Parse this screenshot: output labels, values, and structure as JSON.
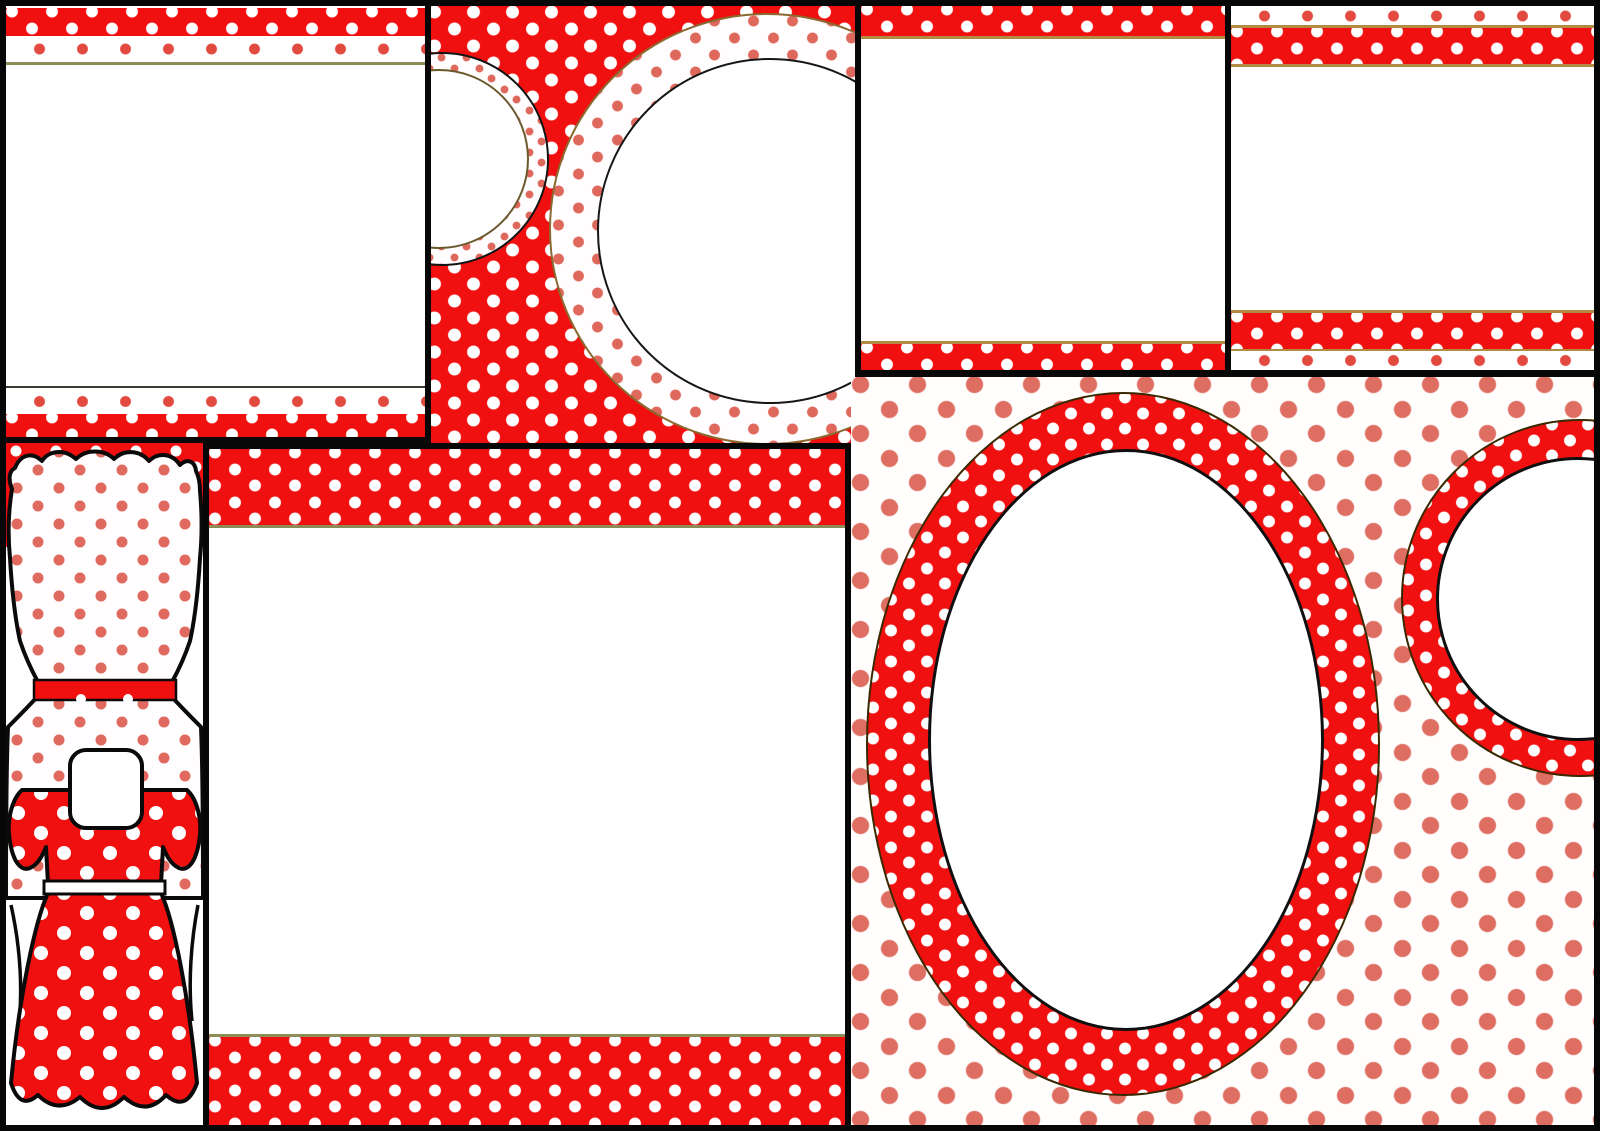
{
  "page": {
    "description": "Collage of seven blank red-and-white polka dot printable party templates: framed cards, ribbon-band labels, circular toppers and a polka dot dress cutout. No text content.",
    "background_color": "#070707"
  },
  "palette": {
    "bright_red": "#f11010",
    "white": "#ffffff",
    "ribbon_dot_red": "#e2493f",
    "soft_dot_salmon": "#df6e62",
    "blouse_dot_red": "#e06a5f",
    "olive_line": "#8d8d58",
    "gold_line": "#b28a42",
    "outline_black": "#0a0a0a"
  },
  "panels": [
    {
      "id": "top-left-frame",
      "kind": "blank card with red polka band and dotted strip top and bottom"
    },
    {
      "id": "top-middle-circles",
      "kind": "red polka background with two white dotted circle frames"
    },
    {
      "id": "top-center-right-frame",
      "kind": "blank card with red polka bands top and bottom"
    },
    {
      "id": "top-far-right-frame",
      "kind": "blank card with dotted strips and red polka bands"
    },
    {
      "id": "left-dress-cutout",
      "kind": "polka dot dress and blouse template with black cut lines"
    },
    {
      "id": "bottom-center-frame",
      "kind": "large blank card with wide red polka bands"
    },
    {
      "id": "bottom-right-circles",
      "kind": "salmon dotted background with two red ring circle frames"
    }
  ]
}
